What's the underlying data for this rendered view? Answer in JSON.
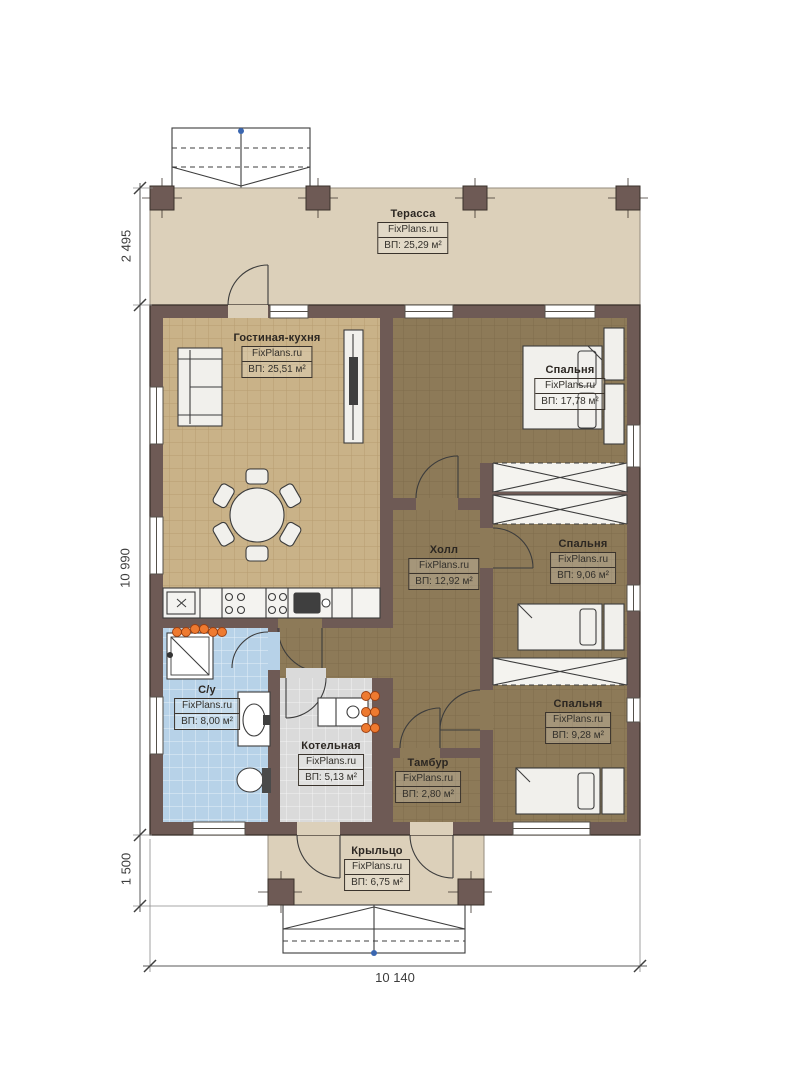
{
  "plan": {
    "brand": "FixPlans.ru",
    "rooms": [
      {
        "id": "terrace",
        "name": "Терасса",
        "brand": "FixPlans.ru",
        "area": "ВП: 25,29 м²"
      },
      {
        "id": "living-kitchen",
        "name": "Гостиная-кухня",
        "brand": "FixPlans.ru",
        "area": "ВП: 25,51 м²"
      },
      {
        "id": "bedroom-1",
        "name": "Спальня",
        "brand": "FixPlans.ru",
        "area": "ВП: 17,78 м²"
      },
      {
        "id": "hall",
        "name": "Холл",
        "brand": "FixPlans.ru",
        "area": "ВП: 12,92 м²"
      },
      {
        "id": "bedroom-2",
        "name": "Спальня",
        "brand": "FixPlans.ru",
        "area": "ВП: 9,06 м²"
      },
      {
        "id": "bedroom-3",
        "name": "Спальня",
        "brand": "FixPlans.ru",
        "area": "ВП: 9,28 м²"
      },
      {
        "id": "bathroom",
        "name": "С/у",
        "brand": "FixPlans.ru",
        "area": "ВП: 8,00 м²"
      },
      {
        "id": "boiler-room",
        "name": "Котельная",
        "brand": "FixPlans.ru",
        "area": "ВП: 5,13 м²"
      },
      {
        "id": "tambour",
        "name": "Тамбур",
        "brand": "FixPlans.ru",
        "area": "ВП: 2,80 м²"
      },
      {
        "id": "porch",
        "name": "Крыльцо",
        "brand": "FixPlans.ru",
        "area": "ВП: 6,75 м²"
      }
    ],
    "dimensions": {
      "left_top": "2 495",
      "left_middle": "10 990",
      "left_bottom": "1 500",
      "bottom_width": "10 140"
    },
    "colors": {
      "wall": "#6e5a55",
      "terrace_floor": "#dcd0ba",
      "living_floor": "#c9b288",
      "bedroom_floor": "#8d7a58",
      "bathroom_floor": "#b7d2e8",
      "boiler_floor": "#dadada",
      "radiator_accent": "#ee7a30",
      "marker_blue": "#3a66b0"
    }
  }
}
